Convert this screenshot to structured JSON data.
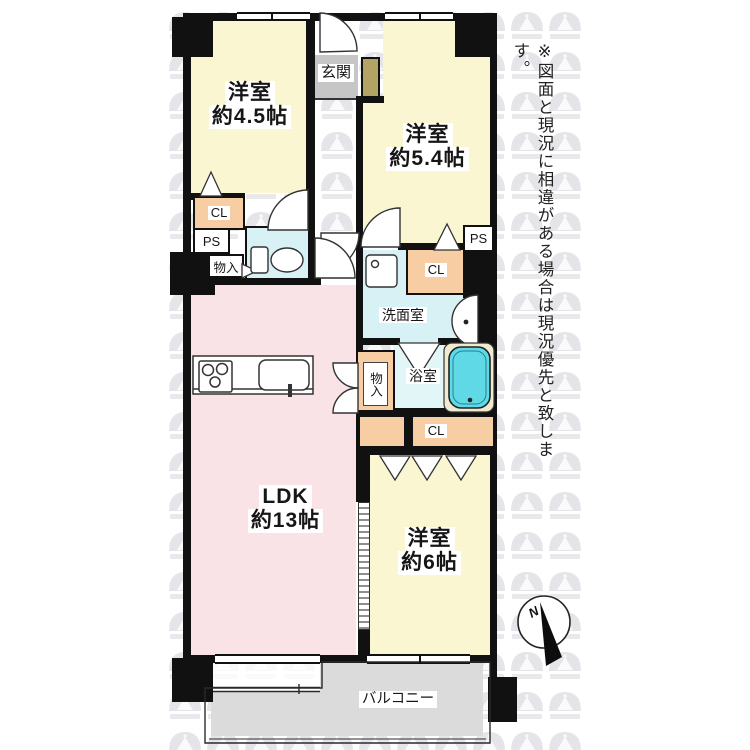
{
  "plan": {
    "rooms": {
      "western_room_45": {
        "line1": "洋室",
        "line2": "約4.5帖"
      },
      "western_room_54": {
        "line1": "洋室",
        "line2": "約5.4帖"
      },
      "western_room_6": {
        "line1": "洋室",
        "line2": "約6帖"
      },
      "ldk": {
        "line1": "LDK",
        "line2": "約13帖"
      },
      "entrance": "玄関",
      "washroom": "洗面室",
      "bathroom": "浴室",
      "balcony": "バルコニー"
    },
    "storage": {
      "closet_1": "CL",
      "closet_2": "CL",
      "closet_3": "CL",
      "pipe_space_1": "PS",
      "pipe_space_2": "PS",
      "storage_1": "物入",
      "storage_2": "物入"
    },
    "compass": {
      "north": "N"
    },
    "disclaimer": "※図面と現況に相違がある場合は現況優先と致します。",
    "colors": {
      "room_yellow": "#faf6d2",
      "ldk_pink": "#fae3e6",
      "water_cyan": "#d8f1f4",
      "bath_cyan": "#e2f6f7",
      "bathtub": "#5fd9e6",
      "closet_orange": "#f7cda3",
      "entrance_gray": "#c6c6c6",
      "shoe_cabinet_tan": "#b3a465",
      "balcony_gray": "#dbdbdb",
      "wall": "#111111"
    }
  }
}
